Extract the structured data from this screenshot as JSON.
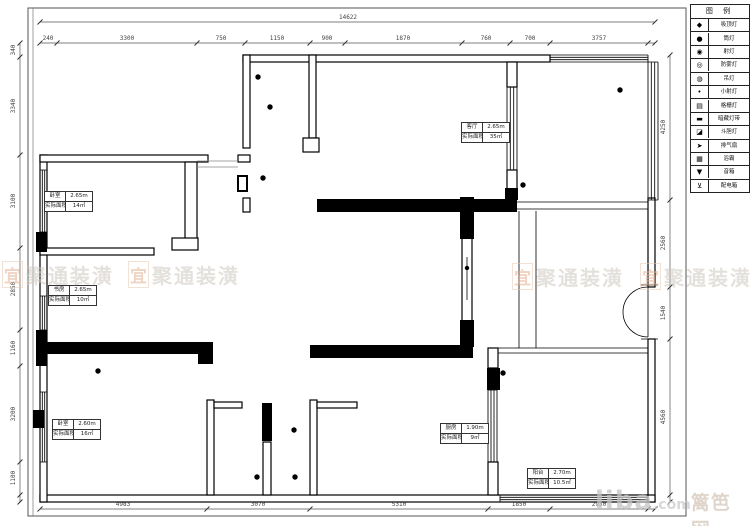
{
  "legend": {
    "title": "图 例",
    "rows": [
      {
        "icon": "◆",
        "label": "吸顶灯"
      },
      {
        "icon": "●",
        "label": "筒灯"
      },
      {
        "icon": "◉",
        "label": "射灯"
      },
      {
        "icon": "◎",
        "label": "防雾灯"
      },
      {
        "icon": "◍",
        "label": "吊灯"
      },
      {
        "icon": "•",
        "label": "小射灯"
      },
      {
        "icon": "▤",
        "label": "格栅灯"
      },
      {
        "icon": "▬",
        "label": "暗藏灯带"
      },
      {
        "icon": "◪",
        "label": "斗胆灯"
      },
      {
        "icon": "➤",
        "label": "排气扇"
      },
      {
        "icon": "▦",
        "label": "浴霸"
      },
      {
        "icon": "▼",
        "label": "音箱"
      },
      {
        "icon": "⊻",
        "label": "配电箱"
      }
    ]
  },
  "rooms": [
    {
      "name": "客厅",
      "height": "2.65m",
      "area_label": "实际面积",
      "area": "35㎡"
    },
    {
      "name": "卧室",
      "height": "2.65m",
      "area_label": "实际面积",
      "area": "14㎡"
    },
    {
      "name": "书房",
      "height": "2.65m",
      "area_label": "实际面积",
      "area": "10㎡"
    },
    {
      "name": "卧室",
      "height": "2.60m",
      "area_label": "实际面积",
      "area": "16㎡"
    },
    {
      "name": "厨房",
      "height": "1.90m",
      "area_label": "实际面积",
      "area": "9㎡"
    },
    {
      "name": "阳台",
      "height": "2.70m",
      "area_label": "实际面积",
      "area": "10.5㎡"
    }
  ],
  "dims": {
    "total_top": "14622",
    "top": [
      "240",
      "3300",
      "750",
      "1150",
      "900",
      "1870",
      "760",
      "700",
      "3757"
    ],
    "left": [
      "340",
      "3340",
      "3100",
      "2850",
      "1160",
      "3200",
      "1100"
    ],
    "right": [
      "4250",
      "2560",
      "1540",
      "4560"
    ],
    "bottom": [
      "4983",
      "3070",
      "5310",
      "1850",
      "2930"
    ]
  },
  "watermark": {
    "logo": "宜",
    "text": "聚通装潢"
  },
  "site_watermark": {
    "brand": "liba",
    "suffix": ".com",
    "site": "篱笆网"
  }
}
